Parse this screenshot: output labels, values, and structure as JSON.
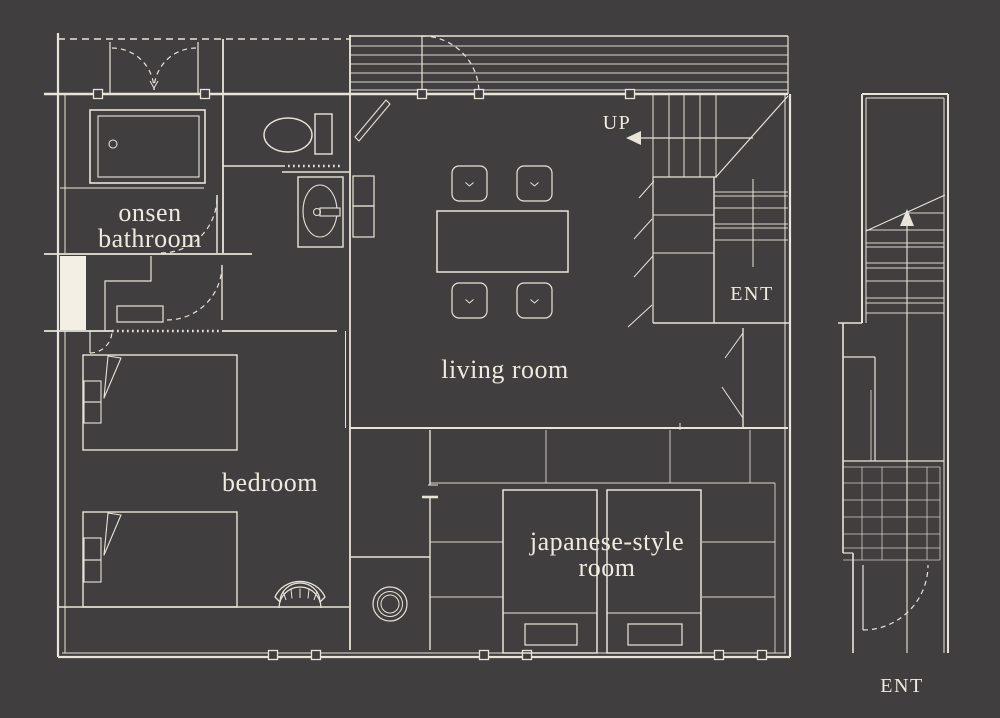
{
  "theme": {
    "bg": "#413E40",
    "line": "#E9E4D9",
    "paper": "#F3EFE4",
    "text": "#EFEAE0"
  },
  "labels": {
    "onsen_bathroom": [
      "onsen",
      "bathroom"
    ],
    "living_room": "living room",
    "bedroom": "bedroom",
    "japanese_style_room": [
      "japanese-style",
      "room"
    ],
    "up": "UP",
    "entrance_main": "ENT",
    "entrance_stairs": "ENT"
  }
}
